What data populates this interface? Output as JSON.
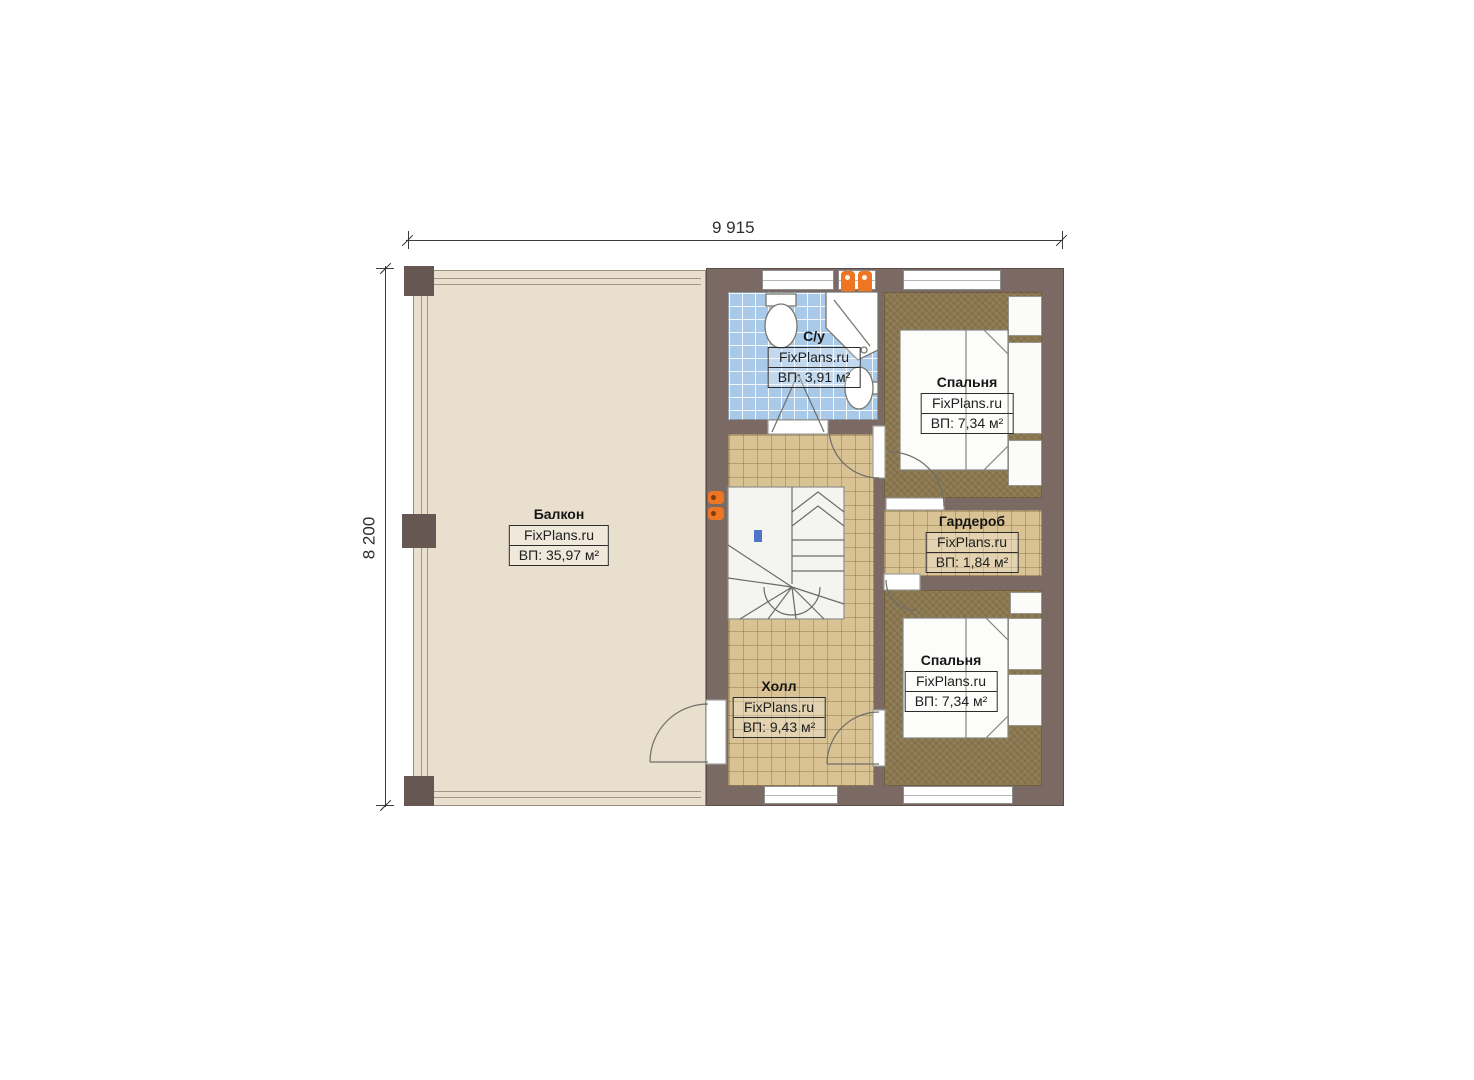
{
  "dimensions": {
    "width": "9 915",
    "height": "8 200"
  },
  "brand": "FixPlans.ru",
  "rooms": {
    "balcony": {
      "name": "Балкон",
      "area": "ВП: 35,97 м²"
    },
    "bathroom": {
      "name": "С/у",
      "area": "ВП: 3,91 м²"
    },
    "bedroom1": {
      "name": "Спальня",
      "area": "ВП: 7,34 м²"
    },
    "wardrobe": {
      "name": "Гардероб",
      "area": "ВП: 1,84 м²"
    },
    "bedroom2": {
      "name": "Спальня",
      "area": "ВП: 7,34 м²"
    },
    "hall": {
      "name": "Холл",
      "area": "ВП: 9,43 м²"
    }
  },
  "colors": {
    "wall": "#7b6a64",
    "wall-dark": "#675752",
    "balcony-floor": "#e9dfce",
    "bathroom-floor": "#a9c9e9",
    "hall-floor": "#d9c294",
    "carpet": "#8c7850",
    "radiator": "#ee7622",
    "stairs": "#f4f4f1",
    "marker-blue": "#4f74c8"
  }
}
